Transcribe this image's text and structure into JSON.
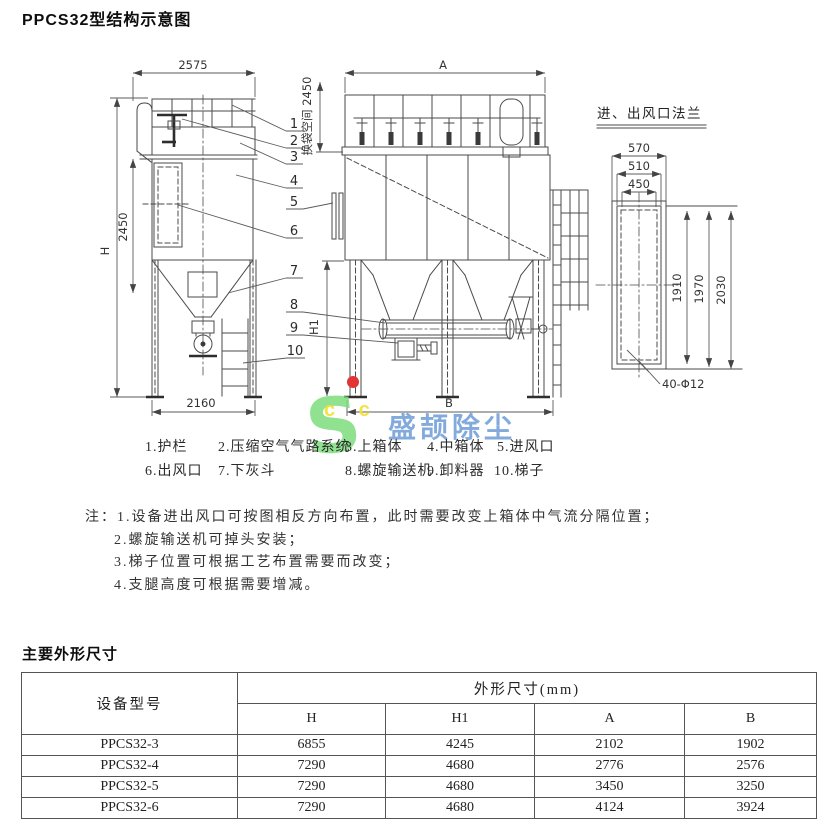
{
  "page": {
    "title": "PPCS32型结构示意图",
    "section2_title": "主要外形尺寸"
  },
  "drawing": {
    "side_view": {
      "width_top": "2575",
      "height_label": "H",
      "body_height": "2450",
      "base_width": "2160"
    },
    "front_view": {
      "width_top": "A",
      "bag_space": "换袋空间 2450",
      "h1_label": "H1",
      "base_width": "B"
    },
    "flange_view": {
      "title": "进、出风口法兰",
      "w1": "570",
      "w2": "510",
      "w3": "450",
      "v1": "1910",
      "v2": "1970",
      "v3": "2030",
      "bolts": "40-Φ12"
    },
    "callouts": [
      "1",
      "2",
      "3",
      "4",
      "5",
      "6",
      "7",
      "8",
      "9",
      "10"
    ]
  },
  "legend": {
    "items": [
      "1.护栏",
      "2.压缩空气气路系统",
      "3.上箱体",
      "4.中箱体",
      "5.进风口",
      "6.出风口",
      "7.下灰斗",
      "8.螺旋输送机",
      "9.卸料器",
      "10.梯子"
    ]
  },
  "notes": {
    "prefix": "注：",
    "items": [
      "1.设备进出风口可按图相反方向布置，此时需要改变上箱体中气流分隔位置；",
      "2.螺旋输送机可掉头安装；",
      "3.梯子位置可根据工艺布置需要而改变；",
      "4.支腿高度可根据需要增减。"
    ]
  },
  "watermark": {
    "logo_letter": "S",
    "logo_sub": "c c",
    "brand": "盛颉除尘"
  },
  "table": {
    "col_model": "设备型号",
    "col_group": "外形尺寸(mm)",
    "sub_cols": [
      "H",
      "H1",
      "A",
      "B"
    ],
    "rows": [
      {
        "model": "PPCS32-3",
        "H": "6855",
        "H1": "4245",
        "A": "2102",
        "B": "1902"
      },
      {
        "model": "PPCS32-4",
        "H": "7290",
        "H1": "4680",
        "A": "2776",
        "B": "2576"
      },
      {
        "model": "PPCS32-5",
        "H": "7290",
        "H1": "4680",
        "A": "3450",
        "B": "3250"
      },
      {
        "model": "PPCS32-6",
        "H": "7290",
        "H1": "4680",
        "A": "4124",
        "B": "3924"
      }
    ]
  }
}
